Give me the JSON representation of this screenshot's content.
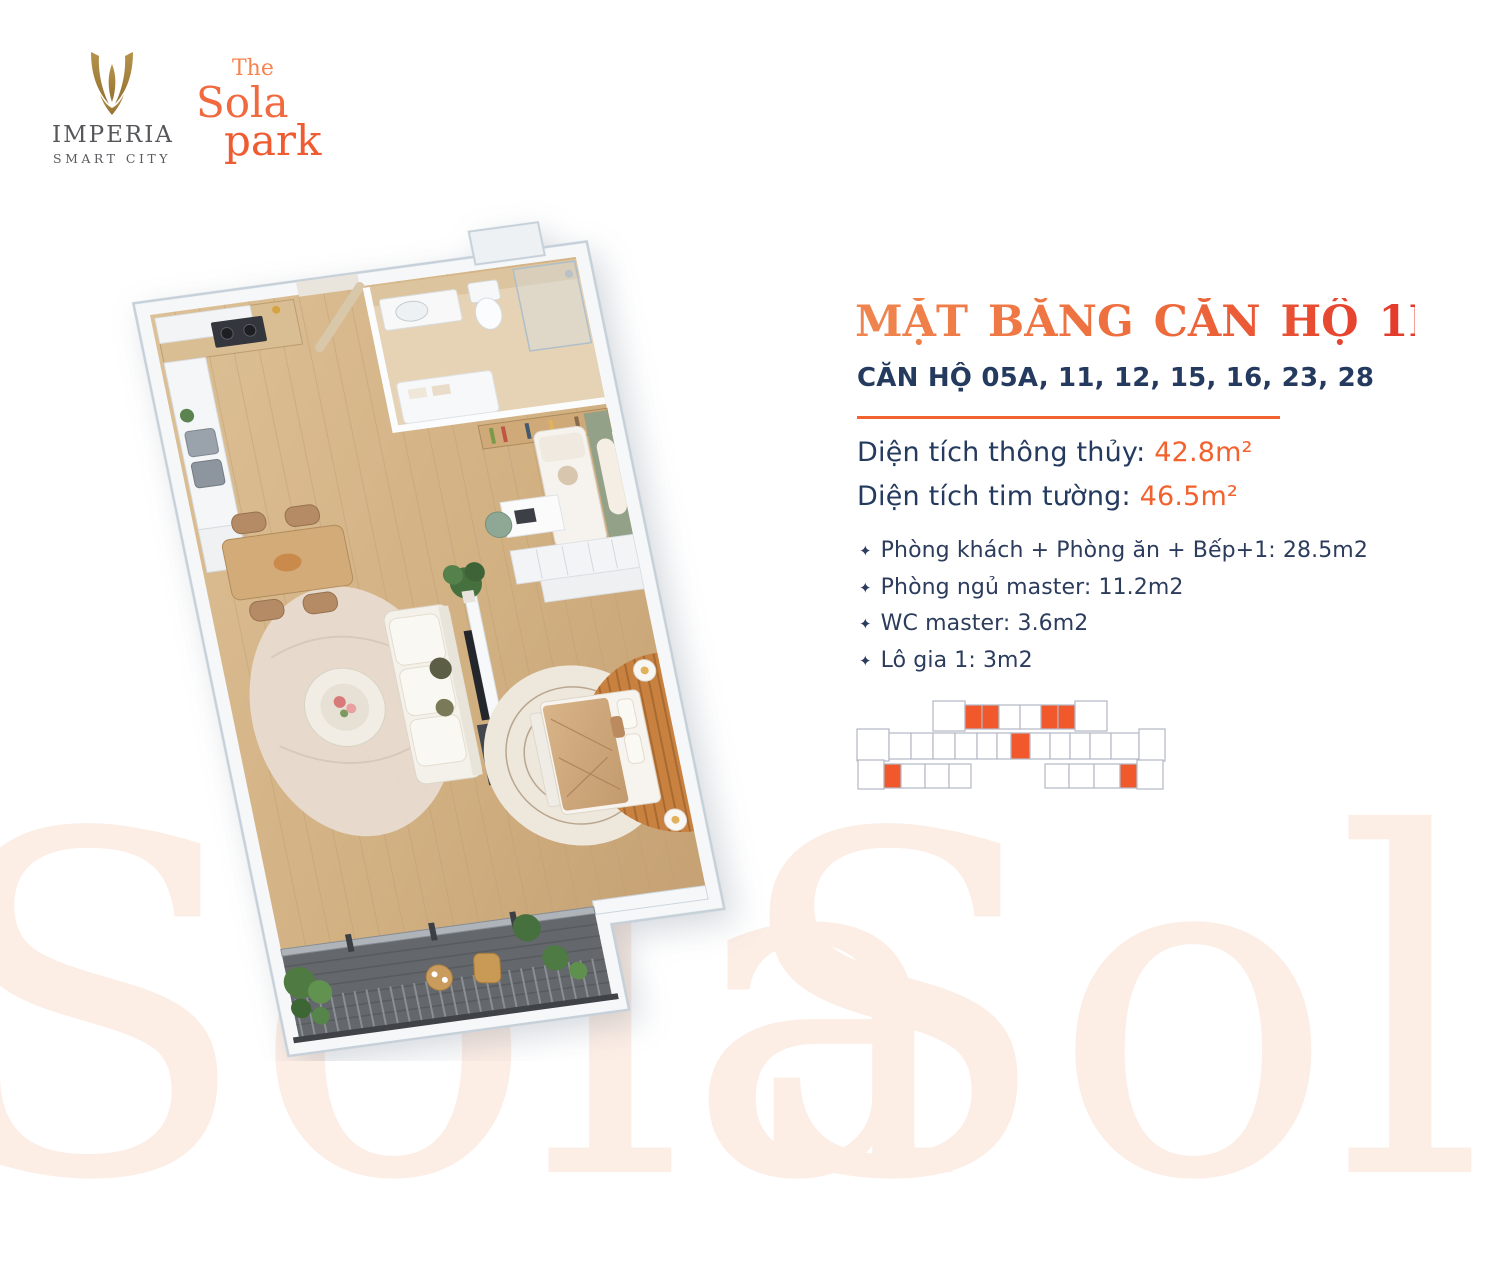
{
  "brand": {
    "imperia_name": "IMPERIA",
    "imperia_tagline": "SMART CITY",
    "sola_the": "The",
    "sola_name": "Sola",
    "sola_park": "park"
  },
  "panel": {
    "title": "MẶT BẰNG CĂN HỘ 1PN+",
    "subtitle": "CĂN HỘ 05A, 11, 12, 15, 16, 23, 28",
    "area_1_label": "Diện tích thông thủy:",
    "area_1_value": "42.8m²",
    "area_2_label": "Diện tích tim tường:",
    "area_2_value": "46.5m²",
    "bullet": "✦",
    "rooms": [
      "Phòng khách + Phòng ăn + Bếp+1: 28.5m2",
      "Phòng ngủ master: 11.2m2",
      "WC master: 3.6m2",
      "Lô gia 1: 3m2"
    ]
  },
  "watermark": {
    "left": "Sola",
    "right": "Sola"
  },
  "keyplan": {
    "units": [
      {
        "x": 78,
        "y": 3,
        "w": 32,
        "h": 30,
        "hl": false
      },
      {
        "x": 110,
        "y": 7,
        "w": 17,
        "h": 24,
        "hl": true
      },
      {
        "x": 127,
        "y": 7,
        "w": 17,
        "h": 24,
        "hl": true
      },
      {
        "x": 144,
        "y": 7,
        "w": 21,
        "h": 24,
        "hl": false
      },
      {
        "x": 165,
        "y": 7,
        "w": 21,
        "h": 24,
        "hl": false
      },
      {
        "x": 186,
        "y": 7,
        "w": 17,
        "h": 24,
        "hl": true
      },
      {
        "x": 203,
        "y": 7,
        "w": 17,
        "h": 24,
        "hl": true
      },
      {
        "x": 220,
        "y": 3,
        "w": 32,
        "h": 30,
        "hl": false
      },
      {
        "x": 2,
        "y": 31,
        "w": 32,
        "h": 32,
        "hl": false
      },
      {
        "x": 34,
        "y": 35,
        "w": 22,
        "h": 26,
        "hl": false
      },
      {
        "x": 56,
        "y": 35,
        "w": 22,
        "h": 26,
        "hl": false
      },
      {
        "x": 78,
        "y": 35,
        "w": 22,
        "h": 26,
        "hl": false
      },
      {
        "x": 100,
        "y": 35,
        "w": 22,
        "h": 26,
        "hl": false
      },
      {
        "x": 122,
        "y": 35,
        "w": 20,
        "h": 26,
        "hl": false
      },
      {
        "x": 142,
        "y": 35,
        "w": 14,
        "h": 26,
        "hl": false
      },
      {
        "x": 156,
        "y": 35,
        "w": 19,
        "h": 26,
        "hl": true
      },
      {
        "x": 175,
        "y": 35,
        "w": 20,
        "h": 26,
        "hl": false
      },
      {
        "x": 195,
        "y": 35,
        "w": 20,
        "h": 26,
        "hl": false
      },
      {
        "x": 215,
        "y": 35,
        "w": 20,
        "h": 26,
        "hl": false
      },
      {
        "x": 235,
        "y": 35,
        "w": 21,
        "h": 26,
        "hl": false
      },
      {
        "x": 256,
        "y": 35,
        "w": 28,
        "h": 26,
        "hl": false
      },
      {
        "x": 284,
        "y": 31,
        "w": 26,
        "h": 32,
        "hl": false
      },
      {
        "x": 3,
        "y": 62,
        "w": 26,
        "h": 29,
        "hl": false
      },
      {
        "x": 29,
        "y": 66,
        "w": 17,
        "h": 24,
        "hl": true
      },
      {
        "x": 46,
        "y": 66,
        "w": 24,
        "h": 24,
        "hl": false
      },
      {
        "x": 70,
        "y": 66,
        "w": 24,
        "h": 24,
        "hl": false
      },
      {
        "x": 94,
        "y": 66,
        "w": 22,
        "h": 24,
        "hl": false
      },
      {
        "x": 190,
        "y": 66,
        "w": 24,
        "h": 24,
        "hl": false
      },
      {
        "x": 214,
        "y": 66,
        "w": 25,
        "h": 24,
        "hl": false
      },
      {
        "x": 239,
        "y": 66,
        "w": 26,
        "h": 24,
        "hl": false
      },
      {
        "x": 265,
        "y": 66,
        "w": 17,
        "h": 24,
        "hl": true
      },
      {
        "x": 282,
        "y": 62,
        "w": 26,
        "h": 29,
        "hl": false
      }
    ]
  },
  "colors": {
    "accent_orange": "#F2622F",
    "title_gradient_start": "#F0854E",
    "title_gradient_end": "#E3372A",
    "navy": "#243A5E",
    "sola_light": "#F58450",
    "sola_mid": "#F1693E",
    "sola_dark": "#EF5C31",
    "gold": "#A8843E",
    "keyplan_highlight": "#F1582B",
    "keyplan_outline": "#B4B8C6",
    "watermark": "#FCEDE5"
  }
}
